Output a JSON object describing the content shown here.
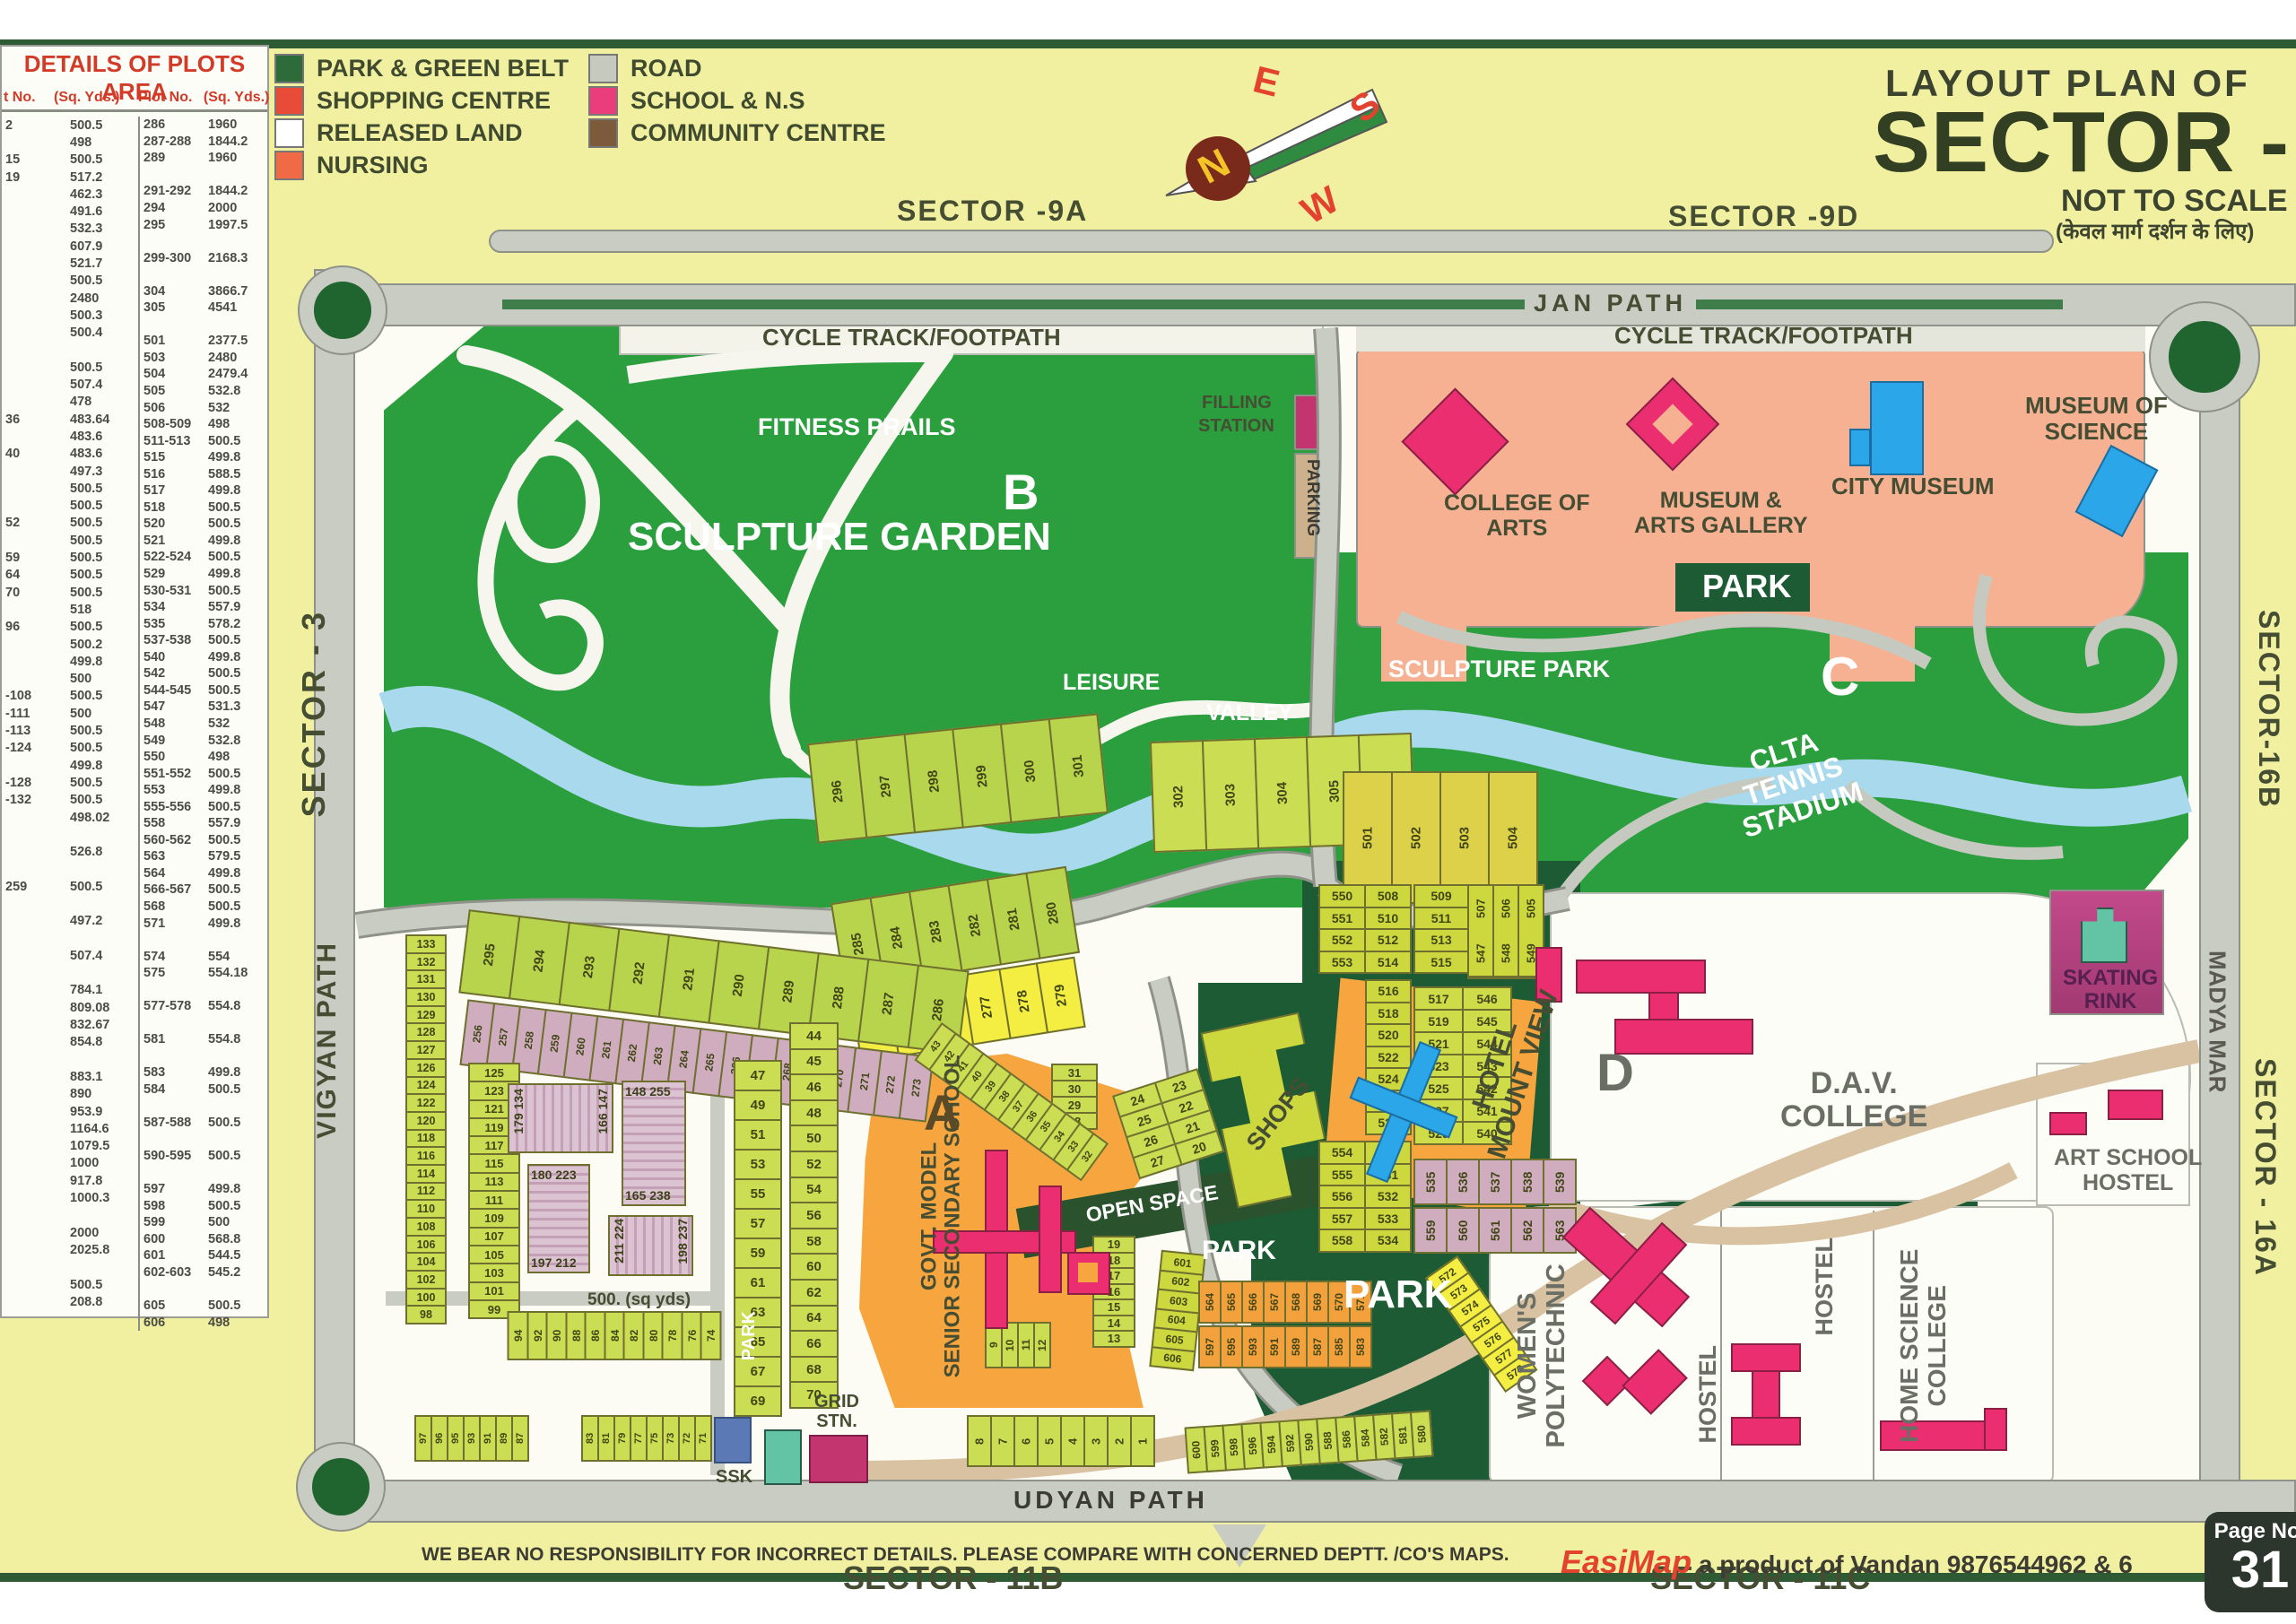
{
  "table": {
    "title": "DETAILS OF PLOTS AREA",
    "header_no_left": "t No.",
    "header_area_left": "(Sq. Yds.)",
    "header_no_right": "Plot No.",
    "header_area_right": "(Sq. Yds.)",
    "left": [
      [
        "2",
        "500.5"
      ],
      [
        "",
        "498"
      ],
      [
        "15",
        "500.5"
      ],
      [
        "19",
        "517.2"
      ],
      [
        "",
        "462.3"
      ],
      [
        "",
        "491.6"
      ],
      [
        "",
        "532.3"
      ],
      [
        "",
        "607.9"
      ],
      [
        "",
        "521.7"
      ],
      [
        "",
        "500.5"
      ],
      [
        "",
        "2480"
      ],
      [
        "",
        "500.3"
      ],
      [
        "",
        "500.4"
      ],
      [
        "",
        ""
      ],
      [
        "",
        "500.5"
      ],
      [
        "",
        "507.4"
      ],
      [
        "",
        "478"
      ],
      [
        "36",
        "483.64"
      ],
      [
        "",
        "483.6"
      ],
      [
        "40",
        "483.6"
      ],
      [
        "",
        "497.3"
      ],
      [
        "",
        "500.5"
      ],
      [
        "",
        "500.5"
      ],
      [
        "52",
        "500.5"
      ],
      [
        "",
        "500.5"
      ],
      [
        "59",
        "500.5"
      ],
      [
        "64",
        "500.5"
      ],
      [
        "70",
        "500.5"
      ],
      [
        "",
        "518"
      ],
      [
        "96",
        "500.5"
      ],
      [
        "",
        "500.2"
      ],
      [
        "",
        "499.8"
      ],
      [
        "",
        "500"
      ],
      [
        "-108",
        "500.5"
      ],
      [
        "-111",
        "500"
      ],
      [
        "-113",
        "500.5"
      ],
      [
        "-124",
        "500.5"
      ],
      [
        "",
        "499.8"
      ],
      [
        "-128",
        "500.5"
      ],
      [
        "-132",
        "500.5"
      ],
      [
        "",
        "498.02"
      ],
      [
        "",
        ""
      ],
      [
        "",
        "526.8"
      ],
      [
        "",
        ""
      ],
      [
        "259",
        "500.5"
      ],
      [
        "",
        ""
      ],
      [
        "",
        "497.2"
      ],
      [
        "",
        ""
      ],
      [
        "",
        "507.4"
      ],
      [
        "",
        ""
      ],
      [
        "",
        "784.1"
      ],
      [
        "",
        "809.08"
      ],
      [
        "",
        "832.67"
      ],
      [
        "",
        "854.8"
      ],
      [
        "",
        ""
      ],
      [
        "",
        "883.1"
      ],
      [
        "",
        "890"
      ],
      [
        "",
        "953.9"
      ],
      [
        "",
        "1164.6"
      ],
      [
        "",
        "1079.5"
      ],
      [
        "",
        "1000"
      ],
      [
        "",
        "917.8"
      ],
      [
        "",
        "1000.3"
      ],
      [
        "",
        ""
      ],
      [
        "",
        "2000"
      ],
      [
        "",
        "2025.8"
      ],
      [
        "",
        ""
      ],
      [
        "",
        "500.5"
      ],
      [
        "",
        "208.8"
      ]
    ],
    "right": [
      [
        "286",
        "1960"
      ],
      [
        "287-288",
        "1844.2"
      ],
      [
        "289",
        "1960"
      ],
      [
        "",
        ""
      ],
      [
        "291-292",
        "1844.2"
      ],
      [
        "294",
        "2000"
      ],
      [
        "295",
        "1997.5"
      ],
      [
        "",
        ""
      ],
      [
        "299-300",
        "2168.3"
      ],
      [
        "",
        ""
      ],
      [
        "304",
        "3866.7"
      ],
      [
        "305",
        "4541"
      ],
      [
        "",
        ""
      ],
      [
        "501",
        "2377.5"
      ],
      [
        "503",
        "2480"
      ],
      [
        "504",
        "2479.4"
      ],
      [
        "505",
        "532.8"
      ],
      [
        "506",
        "532"
      ],
      [
        "508-509",
        "498"
      ],
      [
        "511-513",
        "500.5"
      ],
      [
        "515",
        "499.8"
      ],
      [
        "516",
        "588.5"
      ],
      [
        "517",
        "499.8"
      ],
      [
        "518",
        "500.5"
      ],
      [
        "520",
        "500.5"
      ],
      [
        "521",
        "499.8"
      ],
      [
        "522-524",
        "500.5"
      ],
      [
        "529",
        "499.8"
      ],
      [
        "530-531",
        "500.5"
      ],
      [
        "534",
        "557.9"
      ],
      [
        "535",
        "578.2"
      ],
      [
        "537-538",
        "500.5"
      ],
      [
        "540",
        "499.8"
      ],
      [
        "542",
        "500.5"
      ],
      [
        "544-545",
        "500.5"
      ],
      [
        "547",
        "531.3"
      ],
      [
        "548",
        "532"
      ],
      [
        "549",
        "532.8"
      ],
      [
        "550",
        "498"
      ],
      [
        "551-552",
        "500.5"
      ],
      [
        "553",
        "499.8"
      ],
      [
        "555-556",
        "500.5"
      ],
      [
        "558",
        "557.9"
      ],
      [
        "560-562",
        "500.5"
      ],
      [
        "563",
        "579.5"
      ],
      [
        "564",
        "499.8"
      ],
      [
        "566-567",
        "500.5"
      ],
      [
        "568",
        "500.5"
      ],
      [
        "571",
        "499.8"
      ],
      [
        "",
        ""
      ],
      [
        "574",
        "554"
      ],
      [
        "575",
        "554.18"
      ],
      [
        "",
        ""
      ],
      [
        "577-578",
        "554.8"
      ],
      [
        "",
        ""
      ],
      [
        "581",
        "554.8"
      ],
      [
        "",
        ""
      ],
      [
        "583",
        "499.8"
      ],
      [
        "584",
        "500.5"
      ],
      [
        "",
        ""
      ],
      [
        "587-588",
        "500.5"
      ],
      [
        "",
        ""
      ],
      [
        "590-595",
        "500.5"
      ],
      [
        "",
        ""
      ],
      [
        "597",
        "499.8"
      ],
      [
        "598",
        "500.5"
      ],
      [
        "599",
        "500"
      ],
      [
        "600",
        "568.8"
      ],
      [
        "601",
        "544.5"
      ],
      [
        "602-603",
        "545.2"
      ],
      [
        "",
        ""
      ],
      [
        "605",
        "500.5"
      ],
      [
        "606",
        "498"
      ]
    ]
  },
  "legend": {
    "items": [
      {
        "label": "PARK & GREEN BELT",
        "color": "#2e6b3a"
      },
      {
        "label": "SHOPPING CENTRE",
        "color": "#e84b38"
      },
      {
        "label": "RELEASED LAND",
        "color": "#ffffff"
      },
      {
        "label": "NURSING",
        "color": "#ef6a45"
      },
      {
        "label": "ROAD",
        "color": "#c6cabe"
      },
      {
        "label": "SCHOOL & N.S",
        "color": "#ea3d7c"
      },
      {
        "label": "COMMUNITY CENTRE",
        "color": "#7b5b3b"
      }
    ]
  },
  "title": {
    "line1": "LAYOUT PLAN OF",
    "line2": "SECTOR - 10",
    "line3": "NOT TO SCALE",
    "line4": "(केवल मार्ग दर्शन के लिए)"
  },
  "compass": {
    "n": "N",
    "e": "E",
    "s": "S",
    "w": "W"
  },
  "labels": {
    "s9a": "SECTOR -9A",
    "s9d": "SECTOR -9D",
    "janpath": "JAN PATH",
    "cycle1": "CYCLE TRACK/FOOTPATH",
    "cycle2": "CYCLE TRACK/FOOTPATH",
    "fitness": "FITNESS PRAILS",
    "b": "B",
    "sculpture_garden": "SCULPTURE GARDEN",
    "leisure": "LEISURE",
    "valley": "VALLEY",
    "filling1": "FILLING",
    "filling2": "STATION",
    "parking": "PARKING",
    "college1": "COLLEGE OF",
    "college2": "ARTS",
    "museum1": "MUSEUM &",
    "museum2": "ARTS GALLERY",
    "city_museum": "CITY MUSEUM",
    "msci1": "MUSEUM OF",
    "msci2": "SCIENCE",
    "park_top": "PARK",
    "sculpture_park": "SCULPTURE PARK",
    "c": "C",
    "clta1": "CLTA",
    "clta2": "TENNIS",
    "clta3": "STADIUM",
    "s3": "SECTOR - 3",
    "vigyan": "VIGYAN PATH",
    "s16b": "SECTOR-16B",
    "madya": "MADYA MAR",
    "s16a": "SECTOR - 16A",
    "open_space": "OPEN SPACE",
    "hotel1": "HOTEL",
    "hotel2": "MOUNT VIEW",
    "shops": "SHOPS",
    "govt1": "GOVT. MODEL",
    "govt2": "SENIOR SECONDARY SCHOOL",
    "a": "A",
    "park_small": "PARK",
    "park_big": "PARK",
    "park_vert": "PARK",
    "sqyds": "500. (sq yds)",
    "grid1": "GRID",
    "grid2": "STN.",
    "ssk": "SSK",
    "d": "D",
    "dav1": "D.A.V.",
    "dav2": "COLLEGE",
    "art1": "ART SCHOOL",
    "art2": "HOSTEL",
    "skating1": "SKATING",
    "skating2": "RINK",
    "womens1": "WOMEN'S",
    "womens2": "POLYTECHNIC",
    "hostel1": "HOSTEL",
    "hostel2": "HOSTEL",
    "home1": "HOME SCIENCE",
    "home2": "COLLEGE",
    "udyan": "UDYAN PATH",
    "s11b": "SECTOR - 11B",
    "s11c": "SECTOR - 11C"
  },
  "blocks": {
    "b1a": "179 134",
    "b1b": "166 147",
    "b2a": "180 223",
    "b2b": "197 212",
    "b3a": "148 255",
    "b3b": "165 238",
    "b4a": "211 224",
    "b4b": "198 237"
  },
  "plot_groups": {
    "arc296": [
      "296",
      "297",
      "298",
      "299",
      "300",
      "301"
    ],
    "arc302": [
      "302",
      "303",
      "304",
      "305",
      "306"
    ],
    "y501": [
      "501",
      "502",
      "503",
      "504"
    ],
    "arc285": [
      "285",
      "284",
      "283",
      "282",
      "281",
      "280"
    ],
    "y274": [
      "274",
      "275",
      "276",
      "277",
      "278",
      "279"
    ],
    "arc295": [
      "295",
      "294",
      "293",
      "292",
      "291",
      "290",
      "289",
      "288",
      "287",
      "286"
    ],
    "mauve256": [
      "256",
      "257",
      "258",
      "259",
      "260",
      "261",
      "262",
      "263",
      "264",
      "265",
      "266",
      "267",
      "268",
      "269",
      "270",
      "271",
      "272",
      "273"
    ],
    "col133": [
      "133",
      "132",
      "131",
      "130",
      "129",
      "128",
      "127",
      "126",
      "124",
      "122",
      "120",
      "118",
      "116",
      "114",
      "112",
      "110",
      "108",
      "106",
      "104",
      "102",
      "100",
      "98"
    ],
    "col125": [
      "125",
      "123",
      "121",
      "119",
      "117",
      "115",
      "113",
      "111",
      "109",
      "107",
      "105",
      "103",
      "101",
      "99"
    ],
    "col47": [
      "47",
      "49",
      "51",
      "53",
      "55",
      "57",
      "59",
      "61",
      "63",
      "65",
      "67",
      "69"
    ],
    "col44": [
      "44",
      "45",
      "46",
      "48",
      "50",
      "52",
      "54",
      "56",
      "58",
      "60",
      "62",
      "64",
      "66",
      "68",
      "70"
    ],
    "row94": [
      "94",
      "92",
      "90",
      "88",
      "86",
      "84",
      "82",
      "80",
      "78",
      "76",
      "74"
    ],
    "row97": [
      "97",
      "96",
      "95",
      "93",
      "91",
      "89",
      "87"
    ],
    "row83": [
      "83",
      "81",
      "79",
      "77",
      "75",
      "73",
      "72",
      "71"
    ],
    "row18": [
      "8",
      "7",
      "6",
      "5",
      "4",
      "3",
      "2",
      "1"
    ],
    "row9": [
      "9",
      "10",
      "11",
      "12"
    ],
    "col19": [
      "19",
      "18",
      "17",
      "16",
      "15",
      "14",
      "13"
    ],
    "col31": [
      "31",
      "30",
      "29",
      "28"
    ],
    "block2024": [
      [
        "24",
        "23"
      ],
      [
        "25",
        "22"
      ],
      [
        "26",
        "21"
      ],
      [
        "27",
        "20"
      ]
    ],
    "diag43": [
      "43",
      "42",
      "41",
      "40",
      "39",
      "38",
      "37",
      "36",
      "35",
      "34",
      "33",
      "32"
    ],
    "dpairA": [
      [
        "550",
        "508"
      ],
      [
        "551",
        "510"
      ],
      [
        "552",
        "512"
      ],
      [
        "553",
        "514"
      ]
    ],
    "dcol516": [
      "516",
      "518",
      "520",
      "522",
      "524",
      "526",
      "528"
    ],
    "dpairB": [
      [
        "554",
        "530"
      ],
      [
        "555",
        "531"
      ],
      [
        "556",
        "532"
      ],
      [
        "557",
        "533"
      ],
      [
        "558",
        "534"
      ]
    ],
    "dcol509": [
      "509",
      "511",
      "513",
      "515"
    ],
    "dcols505": [
      [
        "507",
        "547"
      ],
      [
        "506",
        "548"
      ],
      [
        "505",
        "549"
      ]
    ],
    "d517": [
      [
        "517",
        "546"
      ],
      [
        "519",
        "545"
      ],
      [
        "521",
        "544"
      ],
      [
        "523",
        "543"
      ],
      [
        "525",
        "542"
      ],
      [
        "527",
        "541"
      ],
      [
        "529",
        "540"
      ]
    ],
    "pink535": [
      "535",
      "536",
      "537",
      "538",
      "539"
    ],
    "pink559": [
      "559",
      "560",
      "561",
      "562",
      "563"
    ],
    "col601": [
      "601",
      "602",
      "603",
      "604",
      "605",
      "606"
    ],
    "row564": [
      "564",
      "565",
      "566",
      "567",
      "568",
      "569",
      "570",
      "571"
    ],
    "row583": [
      "597",
      "595",
      "593",
      "591",
      "589",
      "587",
      "585",
      "583"
    ],
    "arc572": [
      "572",
      "573",
      "574",
      "575",
      "576",
      "577",
      "578"
    ],
    "arc600": [
      "600",
      "599",
      "598",
      "596",
      "594",
      "592",
      "590",
      "588",
      "586",
      "584",
      "582",
      "581",
      "580"
    ]
  },
  "footer": {
    "disclaimer": "WE BEAR NO RESPONSIBILITY FOR INCORRECT DETAILS. PLEASE COMPARE WITH CONCERNED DEPTT. /CO'S MAPS.",
    "brand": "EasiMap",
    "brand_rest": " a product of Vandan 9876544962 & 6",
    "page_label": "Page No.",
    "page_no": "31"
  }
}
